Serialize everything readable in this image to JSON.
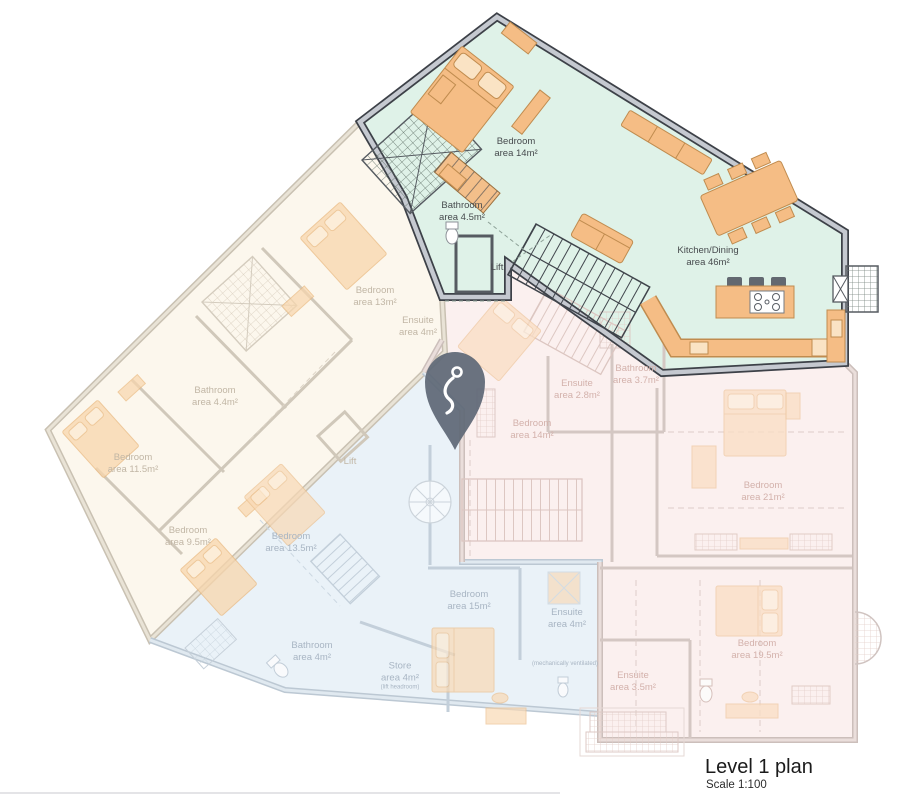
{
  "plan": {
    "title": "Level 1 plan",
    "scale": "Scale 1:100"
  },
  "marker": {
    "icon": "location-pin",
    "fill": "#5f6876"
  },
  "units": [
    {
      "id": "highlighted",
      "state": "active",
      "fill": "#dff2e8"
    },
    {
      "id": "west",
      "state": "faded",
      "fill": "#fcf7ed"
    },
    {
      "id": "south",
      "state": "faded",
      "fill": "#eaf2f8"
    },
    {
      "id": "east",
      "state": "faded",
      "fill": "#fbf0ef"
    }
  ],
  "rooms": [
    {
      "unit": "highlighted",
      "name": "Bedroom",
      "area": "area 14m²"
    },
    {
      "unit": "highlighted",
      "name": "Bathroom",
      "area": "area 4.5m²"
    },
    {
      "unit": "highlighted",
      "name": "Lift",
      "area": ""
    },
    {
      "unit": "highlighted",
      "name": "Kitchen/Dining",
      "area": "area 46m²"
    },
    {
      "unit": "west",
      "name": "Bedroom",
      "area": "area 13m²"
    },
    {
      "unit": "west",
      "name": "Ensuite",
      "area": "area 4m²"
    },
    {
      "unit": "west",
      "name": "Bathroom",
      "area": "area 4.4m²"
    },
    {
      "unit": "west",
      "name": "Bedroom",
      "area": "area 11.5m²"
    },
    {
      "unit": "west",
      "name": "Bedroom",
      "area": "area 9.5m²"
    },
    {
      "unit": "west",
      "name": "Lift",
      "area": ""
    },
    {
      "unit": "south",
      "name": "Bedroom",
      "area": "area 13.5m²"
    },
    {
      "unit": "south",
      "name": "Bathroom",
      "area": "area 4m²"
    },
    {
      "unit": "south",
      "name": "Store",
      "area": "area 4m²",
      "note": "(lift headroom)"
    },
    {
      "unit": "south",
      "name": "Bedroom",
      "area": "area 15m²"
    },
    {
      "unit": "south",
      "name": "Ensuite",
      "area": "area 4m²",
      "note": "(mechanically ventilated)"
    },
    {
      "unit": "east",
      "name": "Ensuite",
      "area": "area 2.8m²"
    },
    {
      "unit": "east",
      "name": "Bathroom",
      "area": "area 3.7m²"
    },
    {
      "unit": "east",
      "name": "Bedroom",
      "area": "area 14m²"
    },
    {
      "unit": "east",
      "name": "Bedroom",
      "area": "area 21m²"
    },
    {
      "unit": "east",
      "name": "Bedroom",
      "area": "area 19.5m²"
    },
    {
      "unit": "east",
      "name": "Ensuite",
      "area": "area 3.5m²"
    }
  ]
}
